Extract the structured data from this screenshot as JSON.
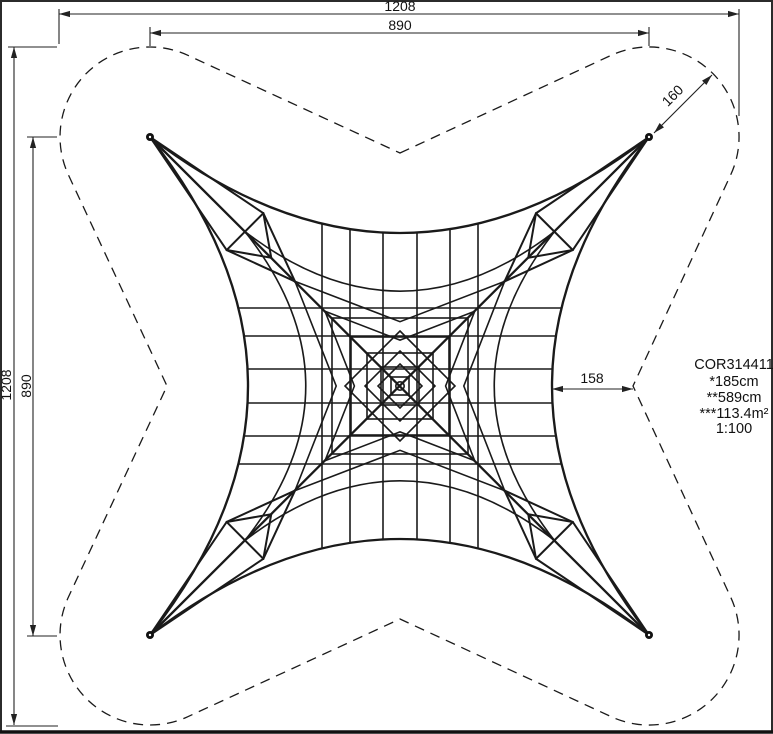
{
  "title_block": {
    "lines": [
      "COR314411",
      "*185cm",
      "**589cm",
      "***113.4m²",
      "1:100"
    ]
  },
  "dimensions": {
    "top_outer": {
      "label": "1208",
      "y": 14,
      "x1": 59,
      "x2": 739,
      "ext": [
        [
          59,
          9,
          59,
          44
        ],
        [
          739,
          9,
          739,
          116
        ]
      ]
    },
    "top_inner": {
      "label": "890",
      "y": 33,
      "x1": 150,
      "x2": 649,
      "ext": [
        [
          150,
          27,
          150,
          46
        ],
        [
          649,
          27,
          649,
          46
        ]
      ]
    },
    "left_outer": {
      "label": "1208",
      "x": 14,
      "y1": 47,
      "y2": 725,
      "ext": [
        [
          8,
          47,
          57,
          47
        ],
        [
          6,
          726,
          58,
          726
        ]
      ]
    },
    "left_inner": {
      "label": "890",
      "x": 33,
      "y1": 137,
      "y2": 636,
      "ext": [
        [
          27,
          137,
          57,
          137
        ],
        [
          27,
          636,
          57,
          636
        ]
      ]
    },
    "right_offset": {
      "label": "158",
      "y": 389,
      "x1": 552,
      "x2": 633
    },
    "corner_radius": {
      "label": "160",
      "x1": 654,
      "y1": 133,
      "x2": 712,
      "y2": 75
    }
  },
  "safety_outline": {
    "radius": 90,
    "notches": [
      [
        400,
        153
      ],
      [
        633,
        386
      ],
      [
        400,
        619
      ],
      [
        167,
        386
      ]
    ]
  },
  "net": {
    "center": [
      400,
      386
    ],
    "corners": [
      [
        150,
        137
      ],
      [
        649,
        137
      ],
      [
        649,
        635
      ],
      [
        150,
        635
      ]
    ],
    "edge_mids": [
      [
        400,
        233
      ],
      [
        552,
        386
      ],
      [
        400,
        539
      ],
      [
        248,
        386
      ]
    ],
    "ring_scales": [
      0.62,
      0.42,
      0.3
    ],
    "box": {
      "inner": 0.515,
      "mid": 0.62,
      "half_width": 26,
      "fan_to": 0.42
    },
    "grid_offsets": [
      -78,
      -50,
      -17,
      17,
      50,
      78
    ],
    "squares": [
      68,
      49,
      33,
      19,
      9
    ],
    "diamonds": [
      55,
      35,
      22
    ],
    "center_circle_r": 4.2,
    "anchor_dot_r": 4
  }
}
